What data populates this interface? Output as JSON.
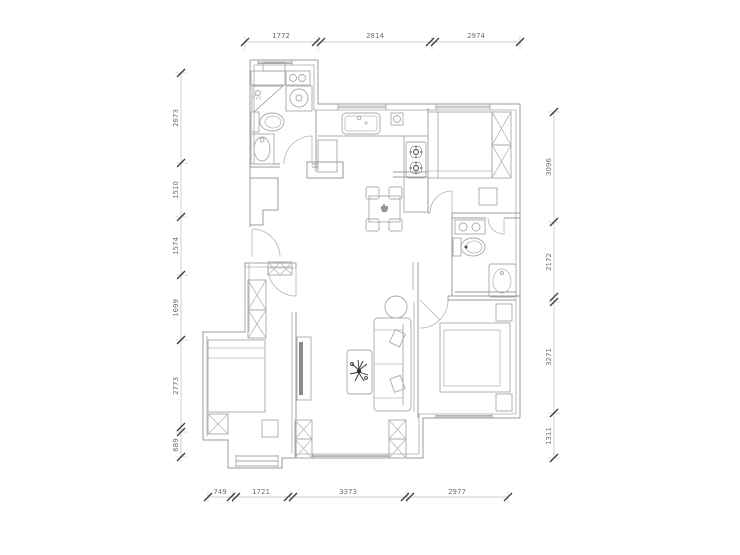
{
  "drawing": {
    "type": "apartment-floor-plan",
    "background": "#ffffff",
    "wall_color": "#9b9b9b",
    "fixture_color": "#a9a9a9",
    "tick_color": "#3a3a3a",
    "dim_text_color": "#6e6e6e",
    "accent_dark": "#2f2f2f"
  },
  "dimensions": {
    "top": [
      "1772",
      "2814",
      "2974"
    ],
    "left": [
      "2673",
      "1510",
      "1574",
      "1699",
      "2773",
      "689"
    ],
    "right": [
      "3096",
      "2172",
      "3271",
      "1311"
    ],
    "bottom": [
      "749",
      "1721",
      "3373",
      "2977"
    ]
  },
  "fixtures": [
    "shower-icon",
    "toilet-icon",
    "sink-icon",
    "washing-machine-icon",
    "kitchen-sink-icon",
    "stove-icon",
    "dining-table-icon",
    "chair-icon",
    "bed-icon",
    "wardrobe-icon",
    "nightstand-icon",
    "sofa-icon",
    "coffee-table-plant-icon",
    "tv-icon",
    "round-table-icon",
    "bathtub-icon",
    "window-icon",
    "door-swing-icon"
  ]
}
